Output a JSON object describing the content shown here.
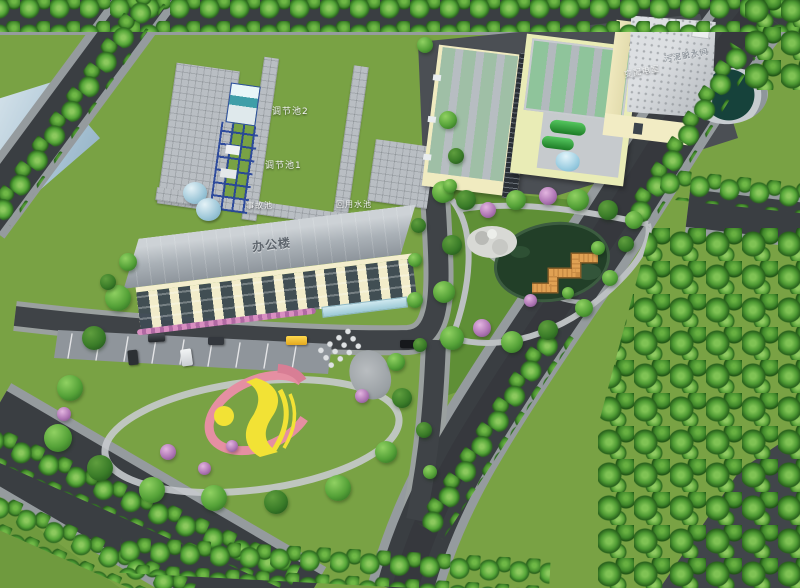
{
  "labels": {
    "pool2": "调节池2",
    "pool1": "调节池1",
    "accident_pool": "事故池",
    "reuse_pool": "回用水池",
    "office_building": "办公楼",
    "sludge_building": "污泥脱水间",
    "power_room": "变配电室"
  },
  "colors": {
    "lawn_green": "#79a244",
    "tree_green": "#4e9a33",
    "road_asphalt": "#3a3e42",
    "sidewalk_gray": "#959b9e",
    "paving_gray": "#b9bec3",
    "wall_cream": "#f2ecc6",
    "roof_gray": "#a6abb0",
    "basin_green": "#8fc49b",
    "tank_green": "#2f9e3a",
    "tank_blue": "#a5d4e4",
    "pond_dark_green": "#223f28",
    "bridge_orange": "#e0a153",
    "logo_pink": "#e58fa2",
    "logo_yellow": "#f2e235",
    "water_blue": "#bcd4e2",
    "clarifier_teal": "#16423b",
    "flower_purple": "#a873ae",
    "gantry_blue": "#24439a"
  }
}
